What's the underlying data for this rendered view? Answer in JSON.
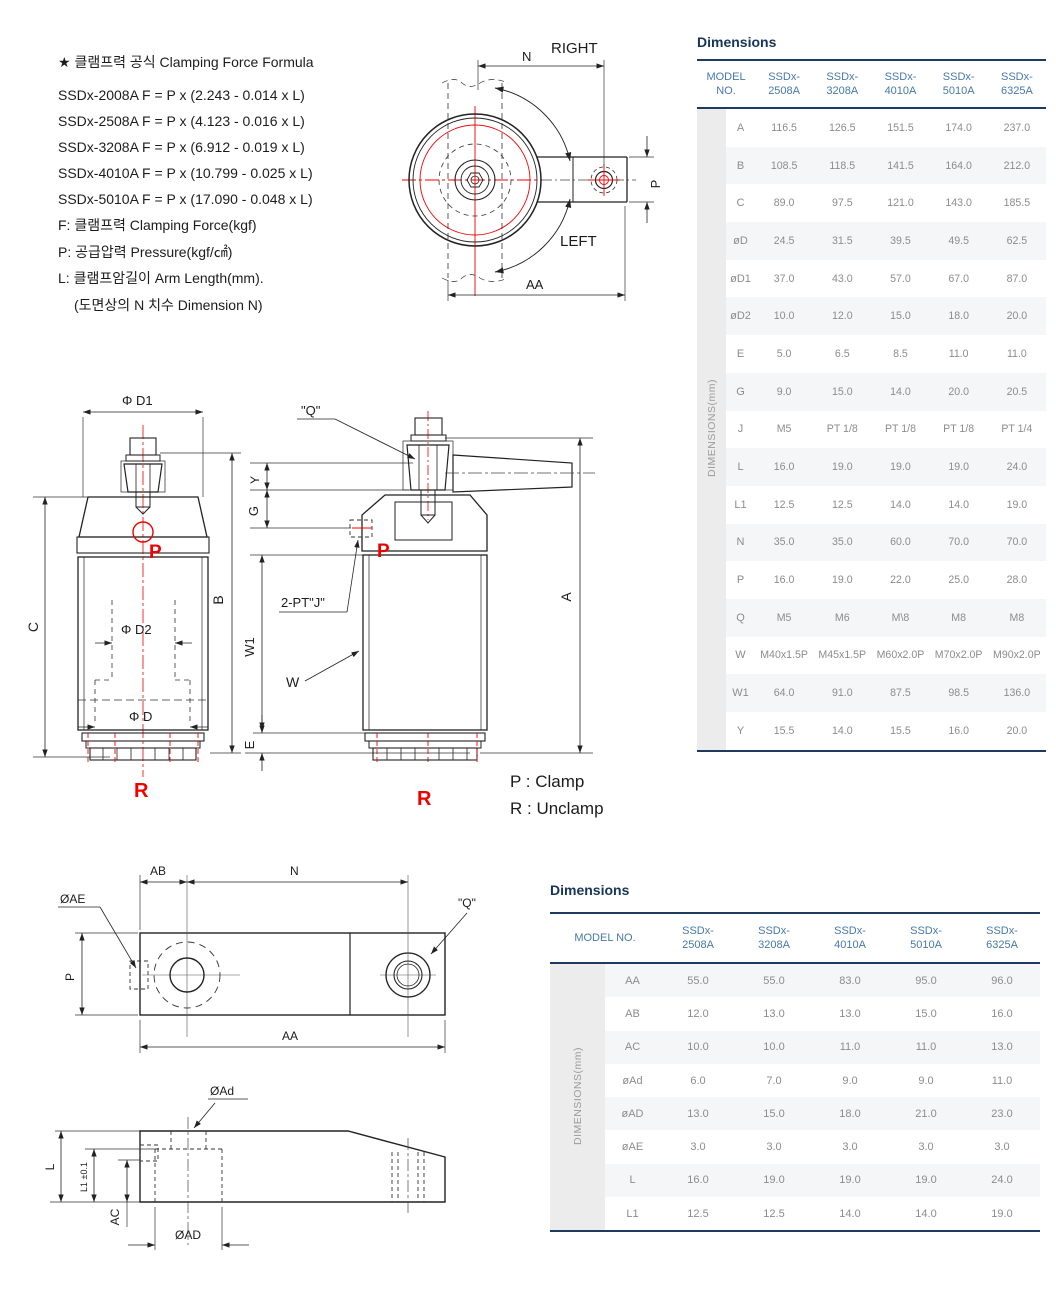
{
  "formula": {
    "title": "★ 클램프력 공식 Clamping Force Formula",
    "lines": [
      "SSDx-2008A  F = P x (2.243 - 0.014 x L)",
      "SSDx-2508A  F = P x (4.123 - 0.016 x L)",
      "SSDx-3208A  F = P x (6.912 - 0.019 x L)",
      "SSDx-4010A  F = P x (10.799 - 0.025 x L)",
      "SSDx-5010A  F = P x (17.090 - 0.048 x L)"
    ],
    "notes": [
      "F: 클램프력 Clamping Force(kgf)",
      "P: 공급압력 Pressure(kgf/㎠)",
      "L: 클램프암길이 Arm Length(mm).",
      "(도면상의 N 치수  Dimension N)"
    ]
  },
  "top_view": {
    "right": "RIGHT",
    "left": "LEFT",
    "dim_n": "N",
    "dim_aa": "AA",
    "dim_p": "P"
  },
  "front_view": {
    "phi_d1": "Φ D1",
    "phi_d2": "Φ D2",
    "phi_d": "Φ D",
    "c": "C",
    "b": "B",
    "y": "Y",
    "g": "G",
    "w1": "W1",
    "e": "E",
    "a": "A",
    "q": "\"Q\"",
    "pt_j": "2-PT\"J\"",
    "w": "W",
    "p": "P",
    "r": "R"
  },
  "legend": {
    "clamp": "P : Clamp",
    "unclamp": "R : Unclamp"
  },
  "arm_top_view": {
    "ab": "AB",
    "n": "N",
    "aa": "AA",
    "p": "P",
    "ae": "ØAE",
    "q": "\"Q\""
  },
  "arm_side_view": {
    "ad_small": "ØAd",
    "l": "L",
    "l1": "L1 ±0.1",
    "ac": "AC",
    "ad": "ØAD"
  },
  "table1": {
    "title": "Dimensions",
    "model_header": "MODEL NO.",
    "side_label": "DIMENSIONS(mm)",
    "models": [
      "SSDx-2508A",
      "SSDx-3208A",
      "SSDx-4010A",
      "SSDx-5010A",
      "SSDx-6325A"
    ],
    "rows": [
      {
        "label": "A",
        "values": [
          "116.5",
          "126.5",
          "151.5",
          "174.0",
          "237.0"
        ]
      },
      {
        "label": "B",
        "values": [
          "108.5",
          "118.5",
          "141.5",
          "164.0",
          "212.0"
        ]
      },
      {
        "label": "C",
        "values": [
          "89.0",
          "97.5",
          "121.0",
          "143.0",
          "185.5"
        ]
      },
      {
        "label": "øD",
        "values": [
          "24.5",
          "31.5",
          "39.5",
          "49.5",
          "62.5"
        ]
      },
      {
        "label": "øD1",
        "values": [
          "37.0",
          "43.0",
          "57.0",
          "67.0",
          "87.0"
        ]
      },
      {
        "label": "øD2",
        "values": [
          "10.0",
          "12.0",
          "15.0",
          "18.0",
          "20.0"
        ]
      },
      {
        "label": "E",
        "values": [
          "5.0",
          "6.5",
          "8.5",
          "11.0",
          "11.0"
        ]
      },
      {
        "label": "G",
        "values": [
          "9.0",
          "15.0",
          "14.0",
          "20.0",
          "20.5"
        ]
      },
      {
        "label": "J",
        "values": [
          "M5",
          "PT 1/8",
          "PT 1/8",
          "PT 1/8",
          "PT 1/4"
        ]
      },
      {
        "label": "L",
        "values": [
          "16.0",
          "19.0",
          "19.0",
          "19.0",
          "24.0"
        ]
      },
      {
        "label": "L1",
        "values": [
          "12.5",
          "12.5",
          "14.0",
          "14.0",
          "19.0"
        ]
      },
      {
        "label": "N",
        "values": [
          "35.0",
          "35.0",
          "60.0",
          "70.0",
          "70.0"
        ]
      },
      {
        "label": "P",
        "values": [
          "16.0",
          "19.0",
          "22.0",
          "25.0",
          "28.0"
        ]
      },
      {
        "label": "Q",
        "values": [
          "M5",
          "M6",
          "M\\8",
          "M8",
          "M8"
        ]
      },
      {
        "label": "W",
        "values": [
          "M40x1.5P",
          "M45x1.5P",
          "M60x2.0P",
          "M70x2.0P",
          "M90x2.0P"
        ]
      },
      {
        "label": "W1",
        "values": [
          "64.0",
          "91.0",
          "87.5",
          "98.5",
          "136.0"
        ]
      },
      {
        "label": "Y",
        "values": [
          "15.5",
          "14.0",
          "15.5",
          "16.0",
          "20.0"
        ]
      }
    ]
  },
  "table2": {
    "title": "Dimensions",
    "model_header": "MODEL NO.",
    "side_label": "DIMENSIONS(mm)",
    "models": [
      "SSDx-2508A",
      "SSDx-3208A",
      "SSDx-4010A",
      "SSDx-5010A",
      "SSDx-6325A"
    ],
    "rows": [
      {
        "label": "AA",
        "values": [
          "55.0",
          "55.0",
          "83.0",
          "95.0",
          "96.0"
        ]
      },
      {
        "label": "AB",
        "values": [
          "12.0",
          "13.0",
          "13.0",
          "15.0",
          "16.0"
        ]
      },
      {
        "label": "AC",
        "values": [
          "10.0",
          "10.0",
          "11.0",
          "11.0",
          "13.0"
        ]
      },
      {
        "label": "øAd",
        "values": [
          "6.0",
          "7.0",
          "9.0",
          "9.0",
          "11.0"
        ]
      },
      {
        "label": "øAD",
        "values": [
          "13.0",
          "15.0",
          "18.0",
          "21.0",
          "23.0"
        ]
      },
      {
        "label": "øAE",
        "values": [
          "3.0",
          "3.0",
          "3.0",
          "3.0",
          "3.0"
        ]
      },
      {
        "label": "L",
        "values": [
          "16.0",
          "19.0",
          "19.0",
          "19.0",
          "24.0"
        ]
      },
      {
        "label": "L1",
        "values": [
          "12.5",
          "12.5",
          "14.0",
          "14.0",
          "19.0"
        ]
      }
    ]
  }
}
